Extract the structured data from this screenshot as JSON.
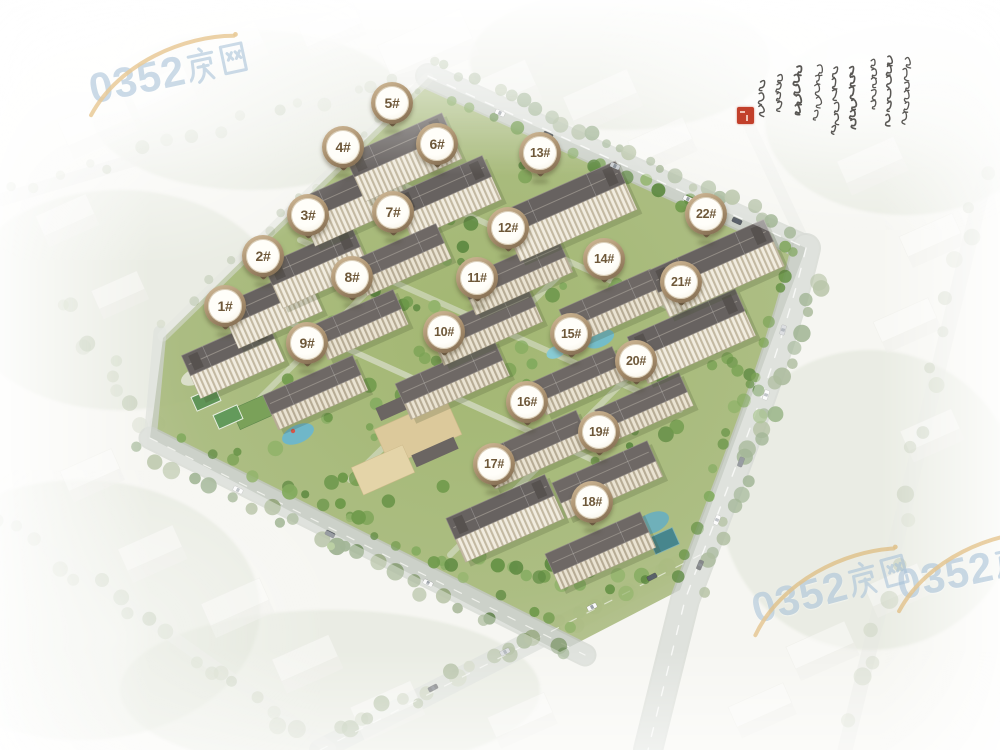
{
  "markers": {
    "shape": "map-pin",
    "ring_color": "#a28a69",
    "face_color": "#fffdf7",
    "text_color": "#6e5839",
    "items": [
      {
        "label": "1#",
        "x": 225,
        "y": 305
      },
      {
        "label": "2#",
        "x": 263,
        "y": 255
      },
      {
        "label": "3#",
        "x": 308,
        "y": 214
      },
      {
        "label": "4#",
        "x": 343,
        "y": 146
      },
      {
        "label": "5#",
        "x": 392,
        "y": 102
      },
      {
        "label": "6#",
        "x": 437,
        "y": 143
      },
      {
        "label": "7#",
        "x": 393,
        "y": 211
      },
      {
        "label": "8#",
        "x": 352,
        "y": 276
      },
      {
        "label": "9#",
        "x": 307,
        "y": 342
      },
      {
        "label": "10#",
        "x": 444,
        "y": 331
      },
      {
        "label": "11#",
        "x": 477,
        "y": 277
      },
      {
        "label": "12#",
        "x": 508,
        "y": 227
      },
      {
        "label": "13#",
        "x": 540,
        "y": 152
      },
      {
        "label": "14#",
        "x": 604,
        "y": 258
      },
      {
        "label": "15#",
        "x": 571,
        "y": 333
      },
      {
        "label": "16#",
        "x": 527,
        "y": 401
      },
      {
        "label": "17#",
        "x": 494,
        "y": 463
      },
      {
        "label": "18#",
        "x": 592,
        "y": 501
      },
      {
        "label": "19#",
        "x": 599,
        "y": 431
      },
      {
        "label": "20#",
        "x": 636,
        "y": 360
      },
      {
        "label": "21#",
        "x": 681,
        "y": 281
      },
      {
        "label": "22#",
        "x": 706,
        "y": 213
      }
    ]
  },
  "watermarks": {
    "text": "0352房网",
    "digits": "0352",
    "suffix": "房网",
    "color": "#a6c0d7",
    "swoosh_color": "#d9a54f",
    "instances": [
      {
        "position": "top-left",
        "x": 88,
        "y": 52,
        "rotation": -12
      },
      {
        "position": "bottom-right",
        "x": 750,
        "y": 568,
        "rotation": -15
      },
      {
        "position": "right-edge-clipped",
        "x": 896,
        "y": 548,
        "rotation": -12
      }
    ]
  },
  "calligraphy": {
    "script": "cursive Chinese brush inscription (illegible grass script)",
    "ink_color": "#35322e",
    "seal_color": "#c2402b"
  }
}
